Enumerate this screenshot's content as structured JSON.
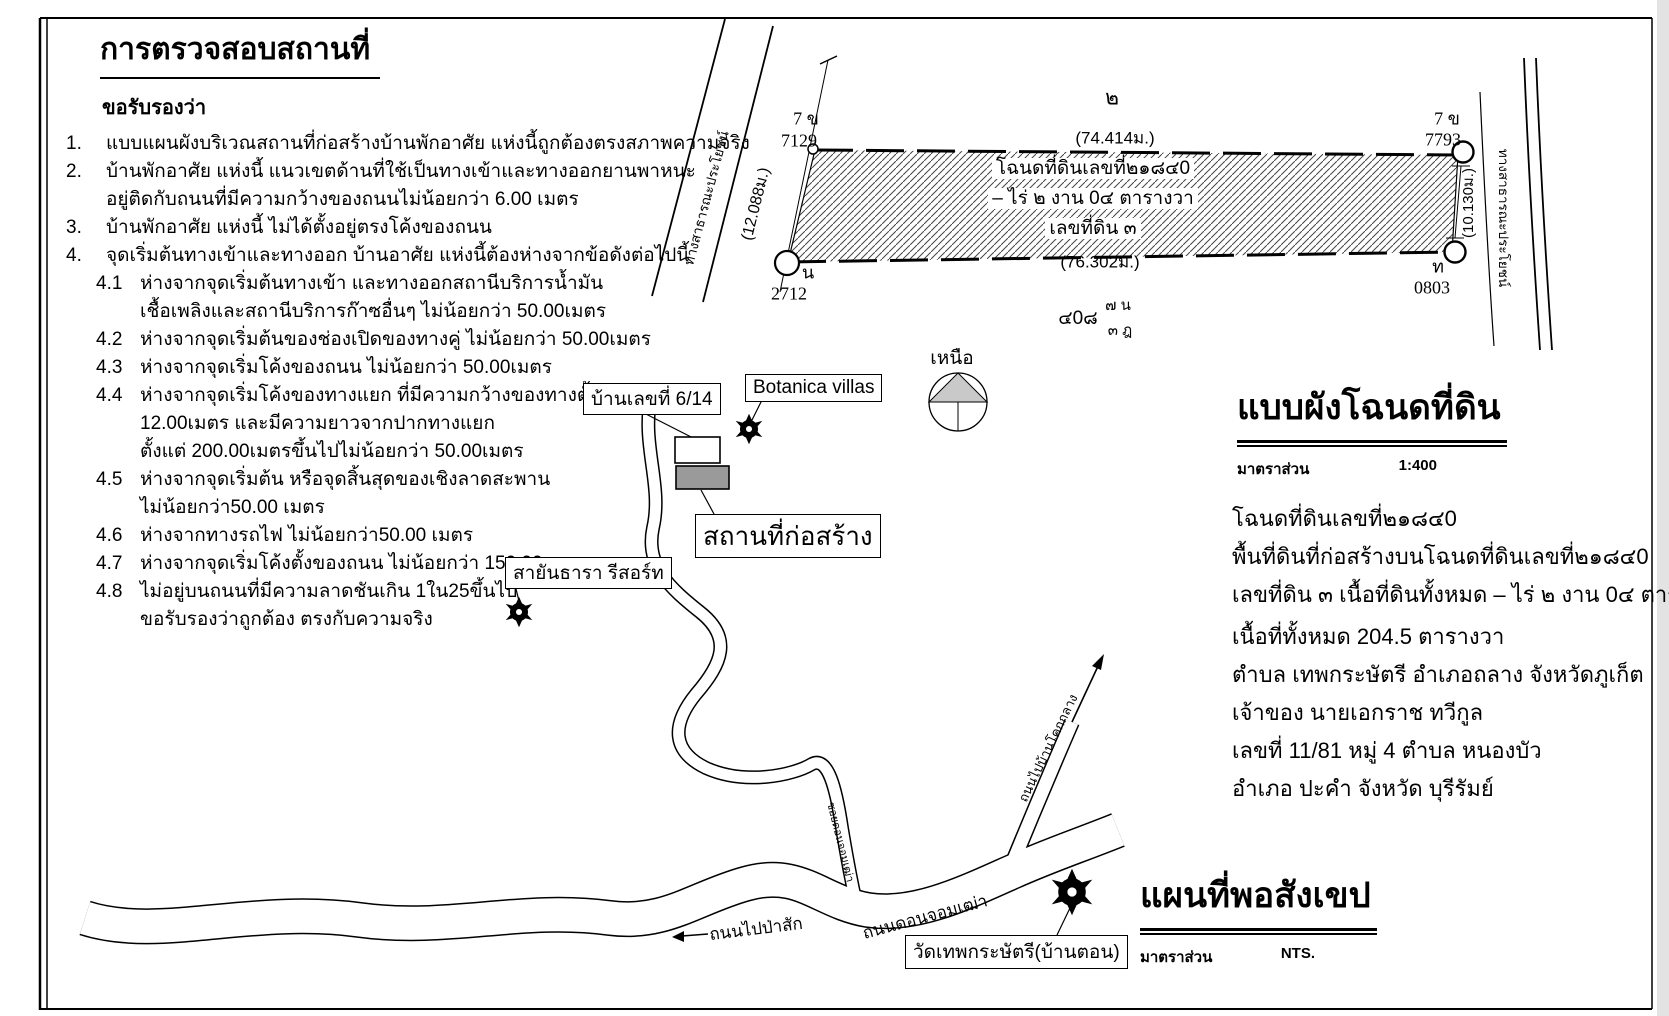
{
  "certification": {
    "title": "การตรวจสอบสถานที่",
    "subtitle": "ขอรับรองว่า",
    "items": [
      {
        "no": "1.",
        "lines": [
          "แบบแผนผังบริเวณสถานที่ก่อสร้างบ้านพักอาศัย แห่งนี้ถูกต้องตรงสภาพความจริง"
        ]
      },
      {
        "no": "2.",
        "lines": [
          "บ้านพักอาศัย แห่งนี้ แนวเขตด้านที่ใช้เป็นทางเข้าและทางออกยานพาหนะ",
          "อยู่ติดกับถนนที่มีความกว้างของถนนไม่น้อยกว่า 6.00 เมตร"
        ]
      },
      {
        "no": "3.",
        "lines": [
          "บ้านพักอาศัย แห่งนี้ ไม่ได้ตั้งอยู่ตรงโค้งของถนน"
        ]
      },
      {
        "no": "4.",
        "lines": [
          "จุดเริ่มต้นทางเข้าและทางออก บ้านอาศัย แห่งนี้ต้องห่างจากข้อดังต่อไปนี้"
        ]
      },
      {
        "no": "4.1",
        "lines": [
          "ห่างจากจุดเริ่มต้นทางเข้า และทางออกสถานีบริการน้ำมัน",
          "เชื้อเพลิงและสถานีบริการก๊าซอื่นๆ ไม่น้อยกว่า 50.00เมตร"
        ]
      },
      {
        "no": "4.2",
        "lines": [
          "ห่างจากจุดเริ่มต้นของช่องเปิดของทางคู่ ไม่น้อยกว่า 50.00เมตร"
        ]
      },
      {
        "no": "4.3",
        "lines": [
          "ห่างจากจุดเริ่มโค้งของถนน ไม่น้อยกว่า 50.00เมตร"
        ]
      },
      {
        "no": "4.4",
        "lines": [
          "ห่างจากจุดเริ่มโค้งของทางแยก ที่มีความกว้างของทางตั้งแต่",
          "12.00เมตร และมีความยาวจากปากทางแยก",
          "ตั้งแต่ 200.00เมตรขึ้นไปไม่น้อยกว่า 50.00เมตร"
        ]
      },
      {
        "no": "4.5",
        "lines": [
          "ห่างจากจุดเริ่มต้น หรือจุดสิ้นสุดของเชิงลาดสะพาน",
          "ไม่น้อยกว่า50.00 เมตร"
        ]
      },
      {
        "no": "4.6",
        "lines": [
          "ห่างจากทางรถไฟ ไม่น้อยกว่า50.00 เมตร"
        ]
      },
      {
        "no": "4.7",
        "lines": [
          "ห่างจากจุดเริ่มโค้งตั้งของถนน ไม่น้อยกว่า 150.00 เมตร"
        ]
      },
      {
        "no": "4.8",
        "lines": [
          "ไม่อยู่บนถนนที่มีความลาดชันเกิน 1ใน25ขึ้นไป",
          "ขอรับรองว่าถูกต้อง ตรงกับความจริง"
        ]
      }
    ]
  },
  "plan": {
    "parcel": {
      "number_above": "๒",
      "deed_line1": "โฉนดที่ดินเลขที่๒๑๘๔0",
      "deed_line2": "– ไร่ ๒ งาน 0๔ ตารางวา",
      "deed_line3": "เลขที่ดิน ๓",
      "dim_top": "(74.414ม.)",
      "dim_bottom": "(76.302ม.)",
      "dim_left": "(12.088ม.)",
      "dim_right": "(10.130ม.)"
    },
    "markers": {
      "top_left": {
        "type": "7 ข",
        "number": "7129"
      },
      "bottom_left": {
        "type": "น",
        "number": "2712"
      },
      "top_right": {
        "type": "7 ข",
        "number": "7793"
      },
      "bottom_right": {
        "type": "ท",
        "number": "0803"
      }
    },
    "survey_note": {
      "main": "๔0๘",
      "upper": "๗ น",
      "lower": "๓ ฎ"
    },
    "road_left_label": "ทางสาธารณะประโยชน์",
    "road_right_label": "ทางสาธารณะประโยชน์",
    "compass_label": "เหนือ"
  },
  "deed_plan": {
    "title": "แบบผังโฉนดที่ดิน",
    "scale_label": "มาตราส่วน",
    "scale_value": "1:400"
  },
  "deed_info": {
    "lines": [
      "โฉนดที่ดินเลขที่๒๑๘๔0",
      "พื้นที่ดินที่ก่อสร้างบนโฉนดที่ดินเลขที่๒๑๘๔0",
      "เลขที่ดิน ๓  เนื้อที่ดินทั้งหมด – ไร่ ๒ งาน 0๔ ตารางวา",
      "เนื้อที่ทั้งหมด 204.5 ตารางวา",
      "ตำบล เทพกระษัตรี อำเภอถลาง จังหวัดภูเก็ต",
      "เจ้าของ นายเอกราช ทวีกูล",
      "เลขที่ 11/81  หมู่ 4  ตำบล หนองบัว",
      "อำเภอ ปะคำ จังหวัด บุรีรัมย์"
    ]
  },
  "sketch_map": {
    "title": "แผนที่พอสังเขป",
    "scale_label": "มาตราส่วน",
    "scale_value": "NTS.",
    "labels": {
      "house": "บ้านเลขที่ 6/14",
      "botanica": "Botanica villas",
      "construction_site": "สถานที่ก่อสร้าง",
      "resort": "สายันธารา รีสอร์ท",
      "temple": "วัดเทพกระษัตรี(บ้านตอน)"
    },
    "roads": {
      "to_pasak": "ถนนไปป่าสัก",
      "don_chom_thao": "ถนนดอนจอมเฒ่า",
      "branch_north": "ถนนไปบ้านโคกกลาง",
      "soi": "ซอยดอนจอมเฒ่า"
    }
  },
  "colors": {
    "building_fill": "#9a9a9a",
    "compass_fill": "#c9c9c9",
    "line": "#000000"
  }
}
